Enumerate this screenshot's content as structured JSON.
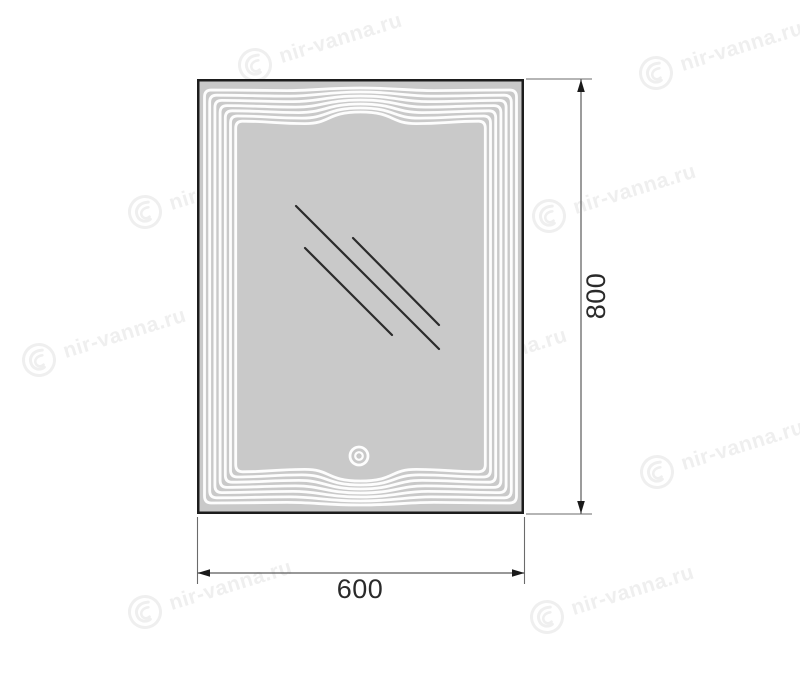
{
  "drawing": {
    "width_label": "600",
    "height_label": "800"
  },
  "watermark": {
    "text": "nir-vanna.ru",
    "logo_icon": "swirl-circle-logo",
    "color": "#efefef",
    "positions": [
      [
        255,
        65
      ],
      [
        656,
        73
      ],
      [
        145,
        212
      ],
      [
        549,
        216
      ],
      [
        39,
        360
      ],
      [
        420,
        380
      ],
      [
        657,
        472
      ],
      [
        145,
        612
      ],
      [
        547,
        617
      ]
    ]
  },
  "colors": {
    "background": "#ffffff",
    "mirror_fill": "#c9c9c9",
    "mirror_border": "#1d1d1d",
    "decorative_line": "#fdfdfd",
    "reflection_line": "#2b2b2b",
    "dimension_line": "#5a5a5a",
    "extension_line": "#6b6b6b",
    "arrow": "#1a1a1a",
    "dimension_text": "#2a2a2a"
  }
}
